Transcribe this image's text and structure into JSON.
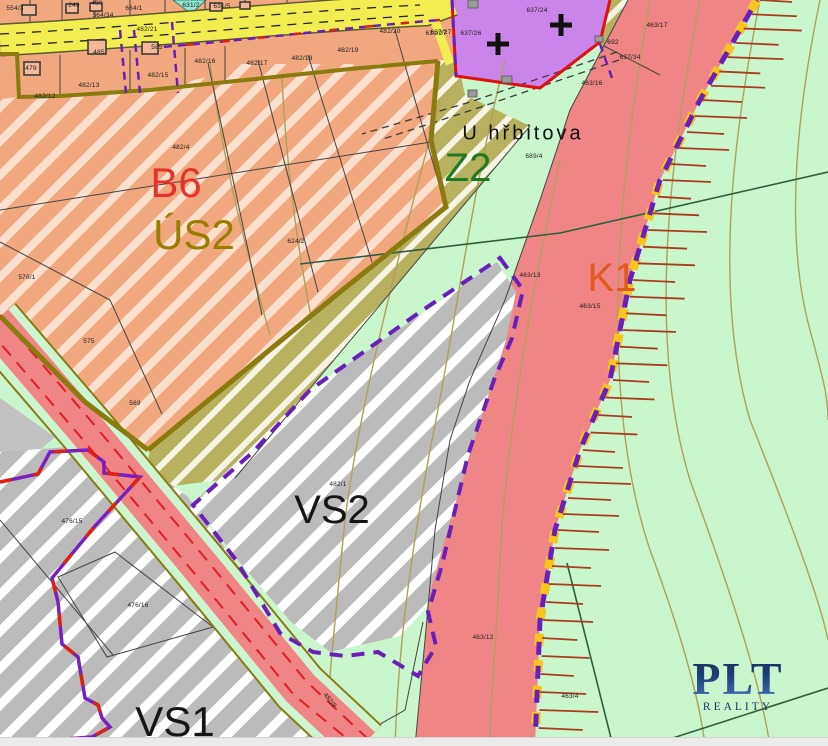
{
  "watermark": {
    "brand": "PLT",
    "sub": "REALITY"
  },
  "place_label": {
    "text": "U hřbitova",
    "x": 523,
    "y": 134,
    "size": 20,
    "color": "#101010"
  },
  "zone_labels": [
    {
      "id": "b6",
      "text": "B6",
      "x": 176,
      "y": 183,
      "color": "#e63329",
      "size": 42
    },
    {
      "id": "us2",
      "text": "ÚS2",
      "x": 194,
      "y": 235,
      "color": "#9a7d00",
      "size": 42
    },
    {
      "id": "z2",
      "text": "Z2",
      "x": 468,
      "y": 168,
      "color": "#1f7a1f",
      "size": 40
    },
    {
      "id": "k1",
      "text": "K1",
      "x": 612,
      "y": 278,
      "color": "#e05a1e",
      "size": 40
    },
    {
      "id": "vs2",
      "text": "VS2",
      "x": 332,
      "y": 510,
      "color": "#161616",
      "size": 40
    },
    {
      "id": "vs1",
      "text": "VS1",
      "x": 175,
      "y": 722,
      "color": "#161616",
      "size": 42
    }
  ],
  "parcel_labels": [
    {
      "text": "554/3",
      "x": 15,
      "y": 9
    },
    {
      "text": "249",
      "x": 74,
      "y": 6
    },
    {
      "text": "480",
      "x": 97,
      "y": 4
    },
    {
      "text": "564/34",
      "x": 103,
      "y": 16
    },
    {
      "text": "664/1",
      "x": 134,
      "y": 9
    },
    {
      "text": "631/2",
      "x": 191,
      "y": 6
    },
    {
      "text": "631/5",
      "x": 222,
      "y": 7
    },
    {
      "text": "482/21",
      "x": 147,
      "y": 30
    },
    {
      "text": "479",
      "x": 31,
      "y": 69
    },
    {
      "text": "485",
      "x": 99,
      "y": 53
    },
    {
      "text": "585",
      "x": 157,
      "y": 48
    },
    {
      "text": "482/12",
      "x": 45,
      "y": 97
    },
    {
      "text": "482/13",
      "x": 89,
      "y": 86
    },
    {
      "text": "482/15",
      "x": 158,
      "y": 76
    },
    {
      "text": "482/16",
      "x": 205,
      "y": 62
    },
    {
      "text": "482/17",
      "x": 257,
      "y": 64
    },
    {
      "text": "482/18",
      "x": 302,
      "y": 59
    },
    {
      "text": "482/19",
      "x": 348,
      "y": 51
    },
    {
      "text": "482/20",
      "x": 390,
      "y": 32
    },
    {
      "text": "631/27",
      "x": 436,
      "y": 34
    },
    {
      "text": "482/4",
      "x": 181,
      "y": 148
    },
    {
      "text": "624/2",
      "x": 296,
      "y": 242
    },
    {
      "text": "578/1",
      "x": 27,
      "y": 278
    },
    {
      "text": "575",
      "x": 89,
      "y": 342
    },
    {
      "text": "569",
      "x": 135,
      "y": 404
    },
    {
      "text": "637/27",
      "x": 441,
      "y": 33
    },
    {
      "text": "637/26",
      "x": 471,
      "y": 34
    },
    {
      "text": "637/24",
      "x": 537,
      "y": 11
    },
    {
      "text": "692",
      "x": 613,
      "y": 43
    },
    {
      "text": "637/34",
      "x": 630,
      "y": 58
    },
    {
      "text": "463/17",
      "x": 657,
      "y": 26
    },
    {
      "text": "463/16",
      "x": 592,
      "y": 84
    },
    {
      "text": "689/4",
      "x": 534,
      "y": 157
    },
    {
      "text": "463/13",
      "x": 530,
      "y": 276
    },
    {
      "text": "463/15",
      "x": 590,
      "y": 307
    },
    {
      "text": "482/1",
      "x": 338,
      "y": 485
    },
    {
      "text": "463/12",
      "x": 483,
      "y": 638
    },
    {
      "text": "463/4",
      "x": 570,
      "y": 697
    },
    {
      "text": "476/15",
      "x": 72,
      "y": 522
    },
    {
      "text": "476/16",
      "x": 138,
      "y": 606
    },
    {
      "text": "482/8",
      "x": 329,
      "y": 701,
      "rot": 52
    }
  ],
  "legend_colors": {
    "residential_b6": "#f1a87e",
    "study_area_us2": "#b7b05f",
    "cemetery": "#cb85ea",
    "greenery": "#c9f6cd",
    "corridor_k1": "#ef8585",
    "production_vs": "#bbbbbb",
    "road": "#f2ee52",
    "boundary_purple": "#6a1fb8",
    "boundary_red": "#dd2211",
    "zone_border_olive": "#8a7a10"
  }
}
